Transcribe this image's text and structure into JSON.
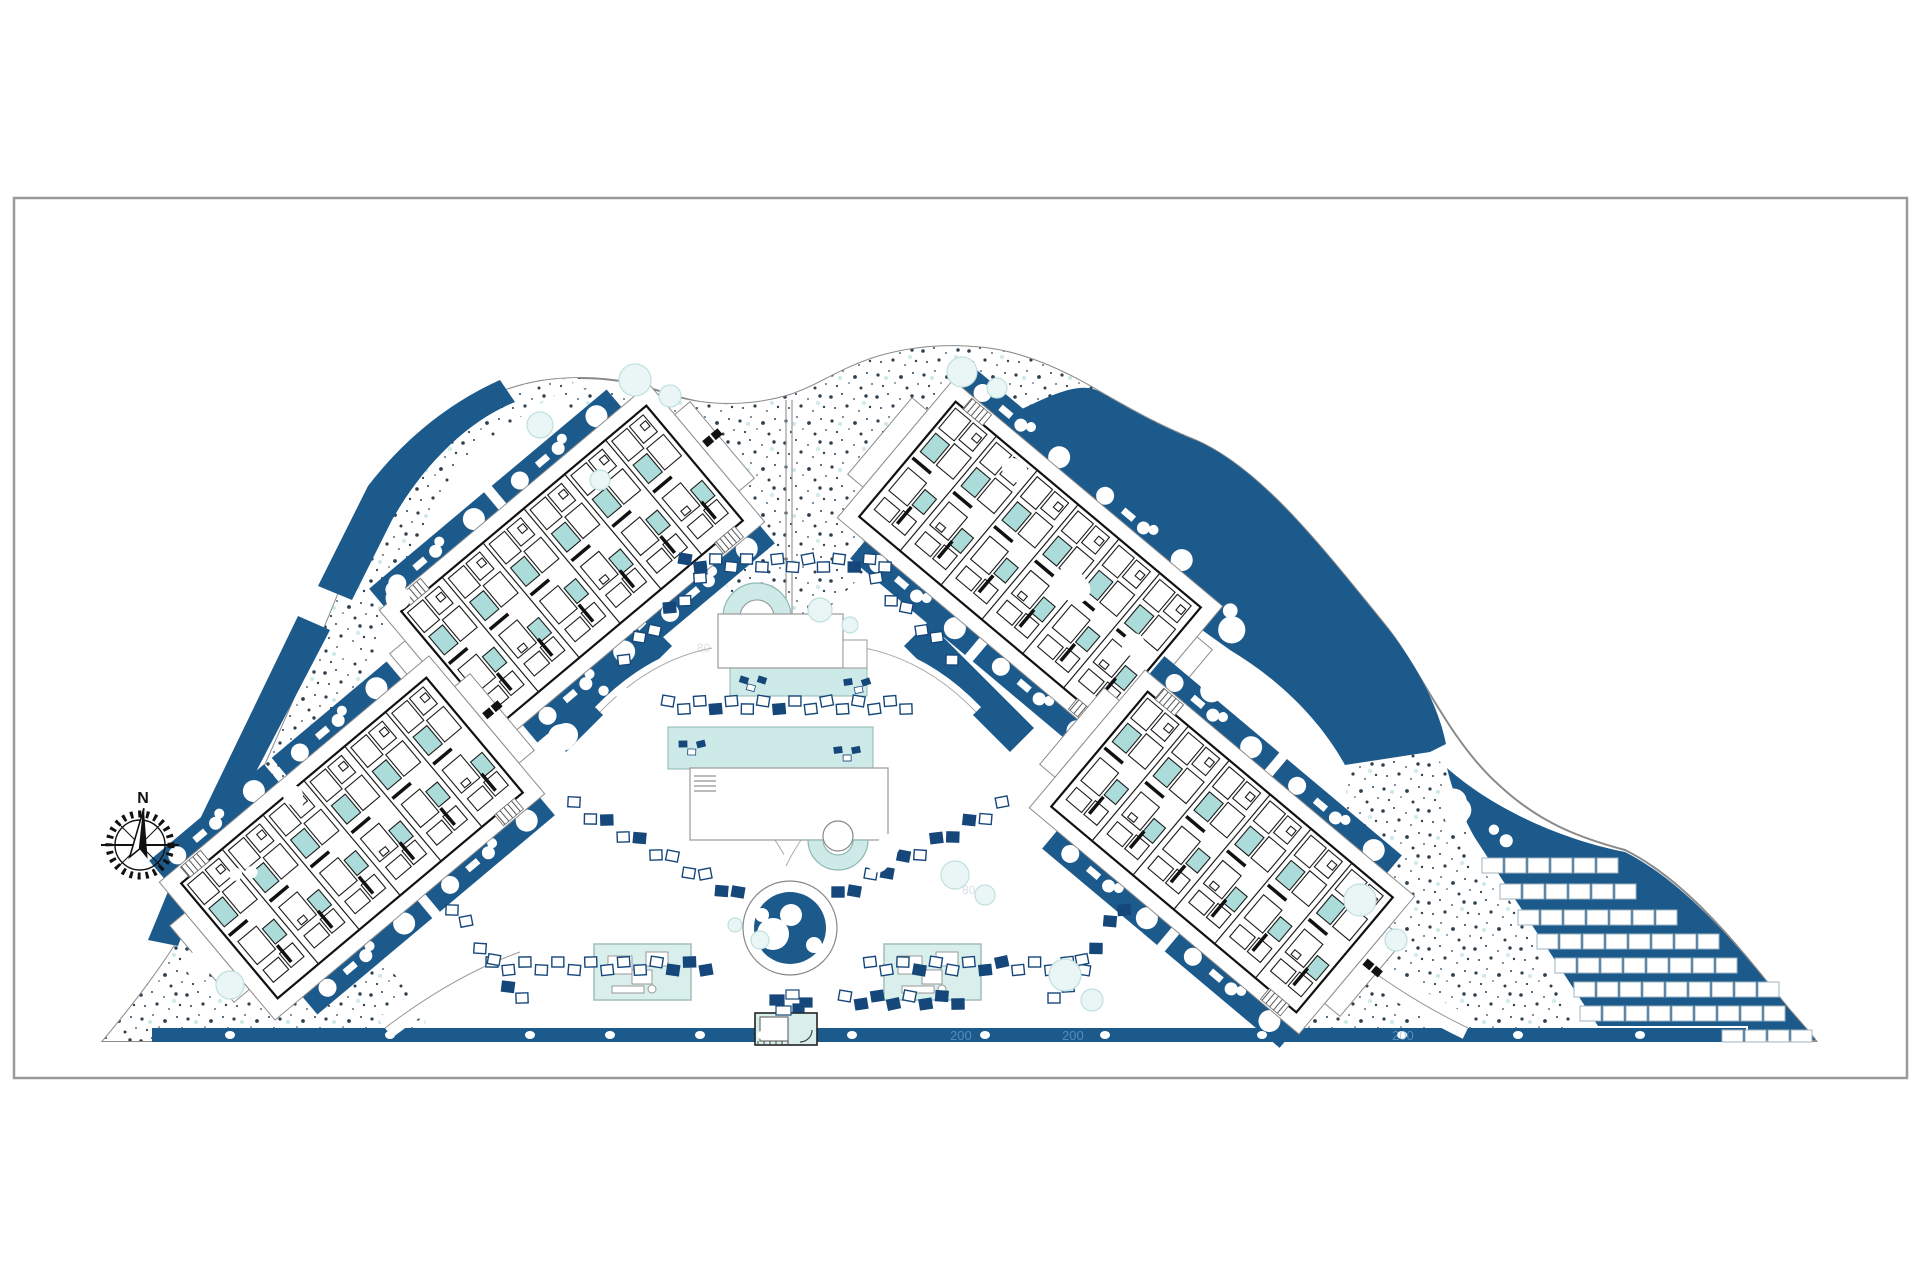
{
  "sheet": {
    "background": "#ffffff",
    "border_color": "#9a9a9a"
  },
  "compass": {
    "label": "N"
  },
  "annotations": {
    "road_markers": [
      {
        "text": "200",
        "x": 950,
        "y": 1040
      },
      {
        "text": "200",
        "x": 1062,
        "y": 1040
      },
      {
        "text": "200",
        "x": 1392,
        "y": 1040
      }
    ],
    "faint_markers": [
      {
        "text": "80",
        "x": 697,
        "y": 652
      },
      {
        "text": "80",
        "x": 962,
        "y": 894
      }
    ]
  },
  "colors": {
    "landscape_blue": "#1d5a8c",
    "deep_blue": "#16477a",
    "pool_teal": "#cdeae8",
    "room_teal": "#abdcd9",
    "pavilion_teal": "#d9efec",
    "tree_teal": "#e9f6f5",
    "line_dark": "#1a1a1a",
    "line_gray": "#8c8c8c",
    "stipple_dark": "#2e3f4e"
  },
  "site_features": [
    "curved-site-boundary",
    "gravel-stipple-landscape",
    "planting-beds",
    "central-pool-axis",
    "circular-pond",
    "sun-lounger-walks",
    "parking-area",
    "perimeter-road"
  ],
  "buildings": [
    {
      "id": "block-nw",
      "cx": 572,
      "cy": 566,
      "rotation": -40,
      "units": 6
    },
    {
      "id": "block-ne",
      "cx": 1030,
      "cy": 562,
      "rotation": 40,
      "units": 6
    },
    {
      "id": "block-sw",
      "cx": 352,
      "cy": 838,
      "rotation": -40,
      "units": 6
    },
    {
      "id": "block-se",
      "cx": 1222,
      "cy": 852,
      "rotation": 40,
      "units": 6
    }
  ],
  "parking": {
    "stall": {
      "w": 21,
      "h": 15,
      "pitch": 23
    },
    "rows": [
      {
        "x": 1482,
        "y": 858,
        "count": 6
      },
      {
        "x": 1500,
        "y": 884,
        "count": 6
      },
      {
        "x": 1518,
        "y": 910,
        "count": 7
      },
      {
        "x": 1537,
        "y": 934,
        "count": 8
      },
      {
        "x": 1555,
        "y": 958,
        "count": 8
      },
      {
        "x": 1574,
        "y": 982,
        "count": 9
      },
      {
        "x": 1580,
        "y": 1006,
        "count": 9
      },
      {
        "x": 1722,
        "y": 1030,
        "count": 4,
        "base": true
      }
    ]
  },
  "pools": {
    "upper_deck": {
      "x": 718,
      "y": 614,
      "w": 125,
      "h": 54
    },
    "upper_pool": {
      "x": 730,
      "y": 664,
      "w": 137,
      "h": 32
    },
    "main_pool": {
      "x": 668,
      "y": 727,
      "w": 205,
      "h": 42
    },
    "lower_deck": {
      "x": 690,
      "y": 768,
      "w": 198,
      "h": 72
    },
    "spa_arc": {
      "cx": 757,
      "cy": 617,
      "router": 34,
      "rinner": 17
    },
    "jacuzzi_arc": {
      "cx": 838,
      "cy": 840,
      "router": 30,
      "rinner": 15
    },
    "pond": {
      "cx": 790,
      "cy": 928,
      "router": 47,
      "rblue": 36
    }
  },
  "pavilions": [
    {
      "id": "pavilion-west",
      "x": 594,
      "y": 944,
      "w": 97,
      "h": 56
    },
    {
      "id": "pavilion-east",
      "x": 884,
      "y": 944,
      "w": 97,
      "h": 56
    }
  ],
  "entrance": {
    "x": 755,
    "y": 1013,
    "w": 62,
    "h": 32
  },
  "lounger_chains": [
    {
      "x1": 685,
      "y1": 563,
      "x2": 885,
      "y2": 563,
      "n": 14
    },
    {
      "x1": 668,
      "y1": 705,
      "x2": 906,
      "y2": 705,
      "n": 16
    },
    {
      "x1": 492,
      "y1": 966,
      "x2": 706,
      "y2": 966,
      "n": 14
    },
    {
      "x1": 870,
      "y1": 966,
      "x2": 1084,
      "y2": 966,
      "n": 14
    },
    {
      "x1": 838,
      "y1": 896,
      "x2": 1002,
      "y2": 806,
      "n": 11
    },
    {
      "x1": 738,
      "y1": 896,
      "x2": 574,
      "y2": 806,
      "n": 11
    },
    {
      "x1": 700,
      "y1": 582,
      "x2": 624,
      "y2": 656,
      "n": 6
    },
    {
      "x1": 876,
      "y1": 582,
      "x2": 952,
      "y2": 656,
      "n": 6
    },
    {
      "x1": 1054,
      "y1": 1002,
      "x2": 1124,
      "y2": 906,
      "n": 6
    },
    {
      "x1": 522,
      "y1": 1002,
      "x2": 452,
      "y2": 906,
      "n": 6
    },
    {
      "x1": 845,
      "y1": 1000,
      "x2": 958,
      "y2": 1000,
      "n": 8
    }
  ],
  "shrub_clusters": [
    [
      205,
      958
    ],
    [
      242,
      872
    ],
    [
      298,
      792
    ],
    [
      352,
      660
    ],
    [
      390,
      588
    ],
    [
      1012,
      468
    ],
    [
      1068,
      582
    ],
    [
      1125,
      640
    ],
    [
      1205,
      688
    ],
    [
      1298,
      742
    ],
    [
      1462,
      806
    ],
    [
      1502,
      832
    ],
    [
      612,
      688
    ],
    [
      565,
      733
    ],
    [
      700,
      855
    ],
    [
      880,
      855
    ],
    [
      560,
      905
    ],
    [
      1240,
      620
    ]
  ],
  "trees": [
    [
      635,
      380,
      16
    ],
    [
      670,
      396,
      11
    ],
    [
      540,
      425,
      13
    ],
    [
      962,
      372,
      15
    ],
    [
      997,
      388,
      10
    ],
    [
      600,
      480,
      10
    ],
    [
      820,
      610,
      12
    ],
    [
      850,
      625,
      8
    ],
    [
      955,
      875,
      14
    ],
    [
      985,
      895,
      10
    ],
    [
      1065,
      975,
      16
    ],
    [
      1092,
      1000,
      11
    ],
    [
      230,
      985,
      14
    ],
    [
      1360,
      900,
      16
    ],
    [
      1396,
      940,
      11
    ],
    [
      760,
      940,
      9
    ],
    [
      735,
      925,
      7
    ]
  ],
  "road_dots": [
    230,
    390,
    530,
    610,
    700,
    762,
    852,
    985,
    1105,
    1262,
    1402,
    1518,
    1640
  ],
  "pool_lounger_icons": [
    [
      744,
      680
    ],
    [
      848,
      682
    ],
    [
      683,
      744
    ],
    [
      838,
      750
    ]
  ],
  "entry_cluster": [
    [
      770,
      995,
      14,
      10,
      "b"
    ],
    [
      786,
      990,
      13,
      9,
      "w"
    ],
    [
      800,
      998,
      12,
      9,
      "b"
    ],
    [
      776,
      1006,
      15,
      9,
      "w"
    ],
    [
      793,
      1004,
      11,
      8,
      "b"
    ]
  ]
}
